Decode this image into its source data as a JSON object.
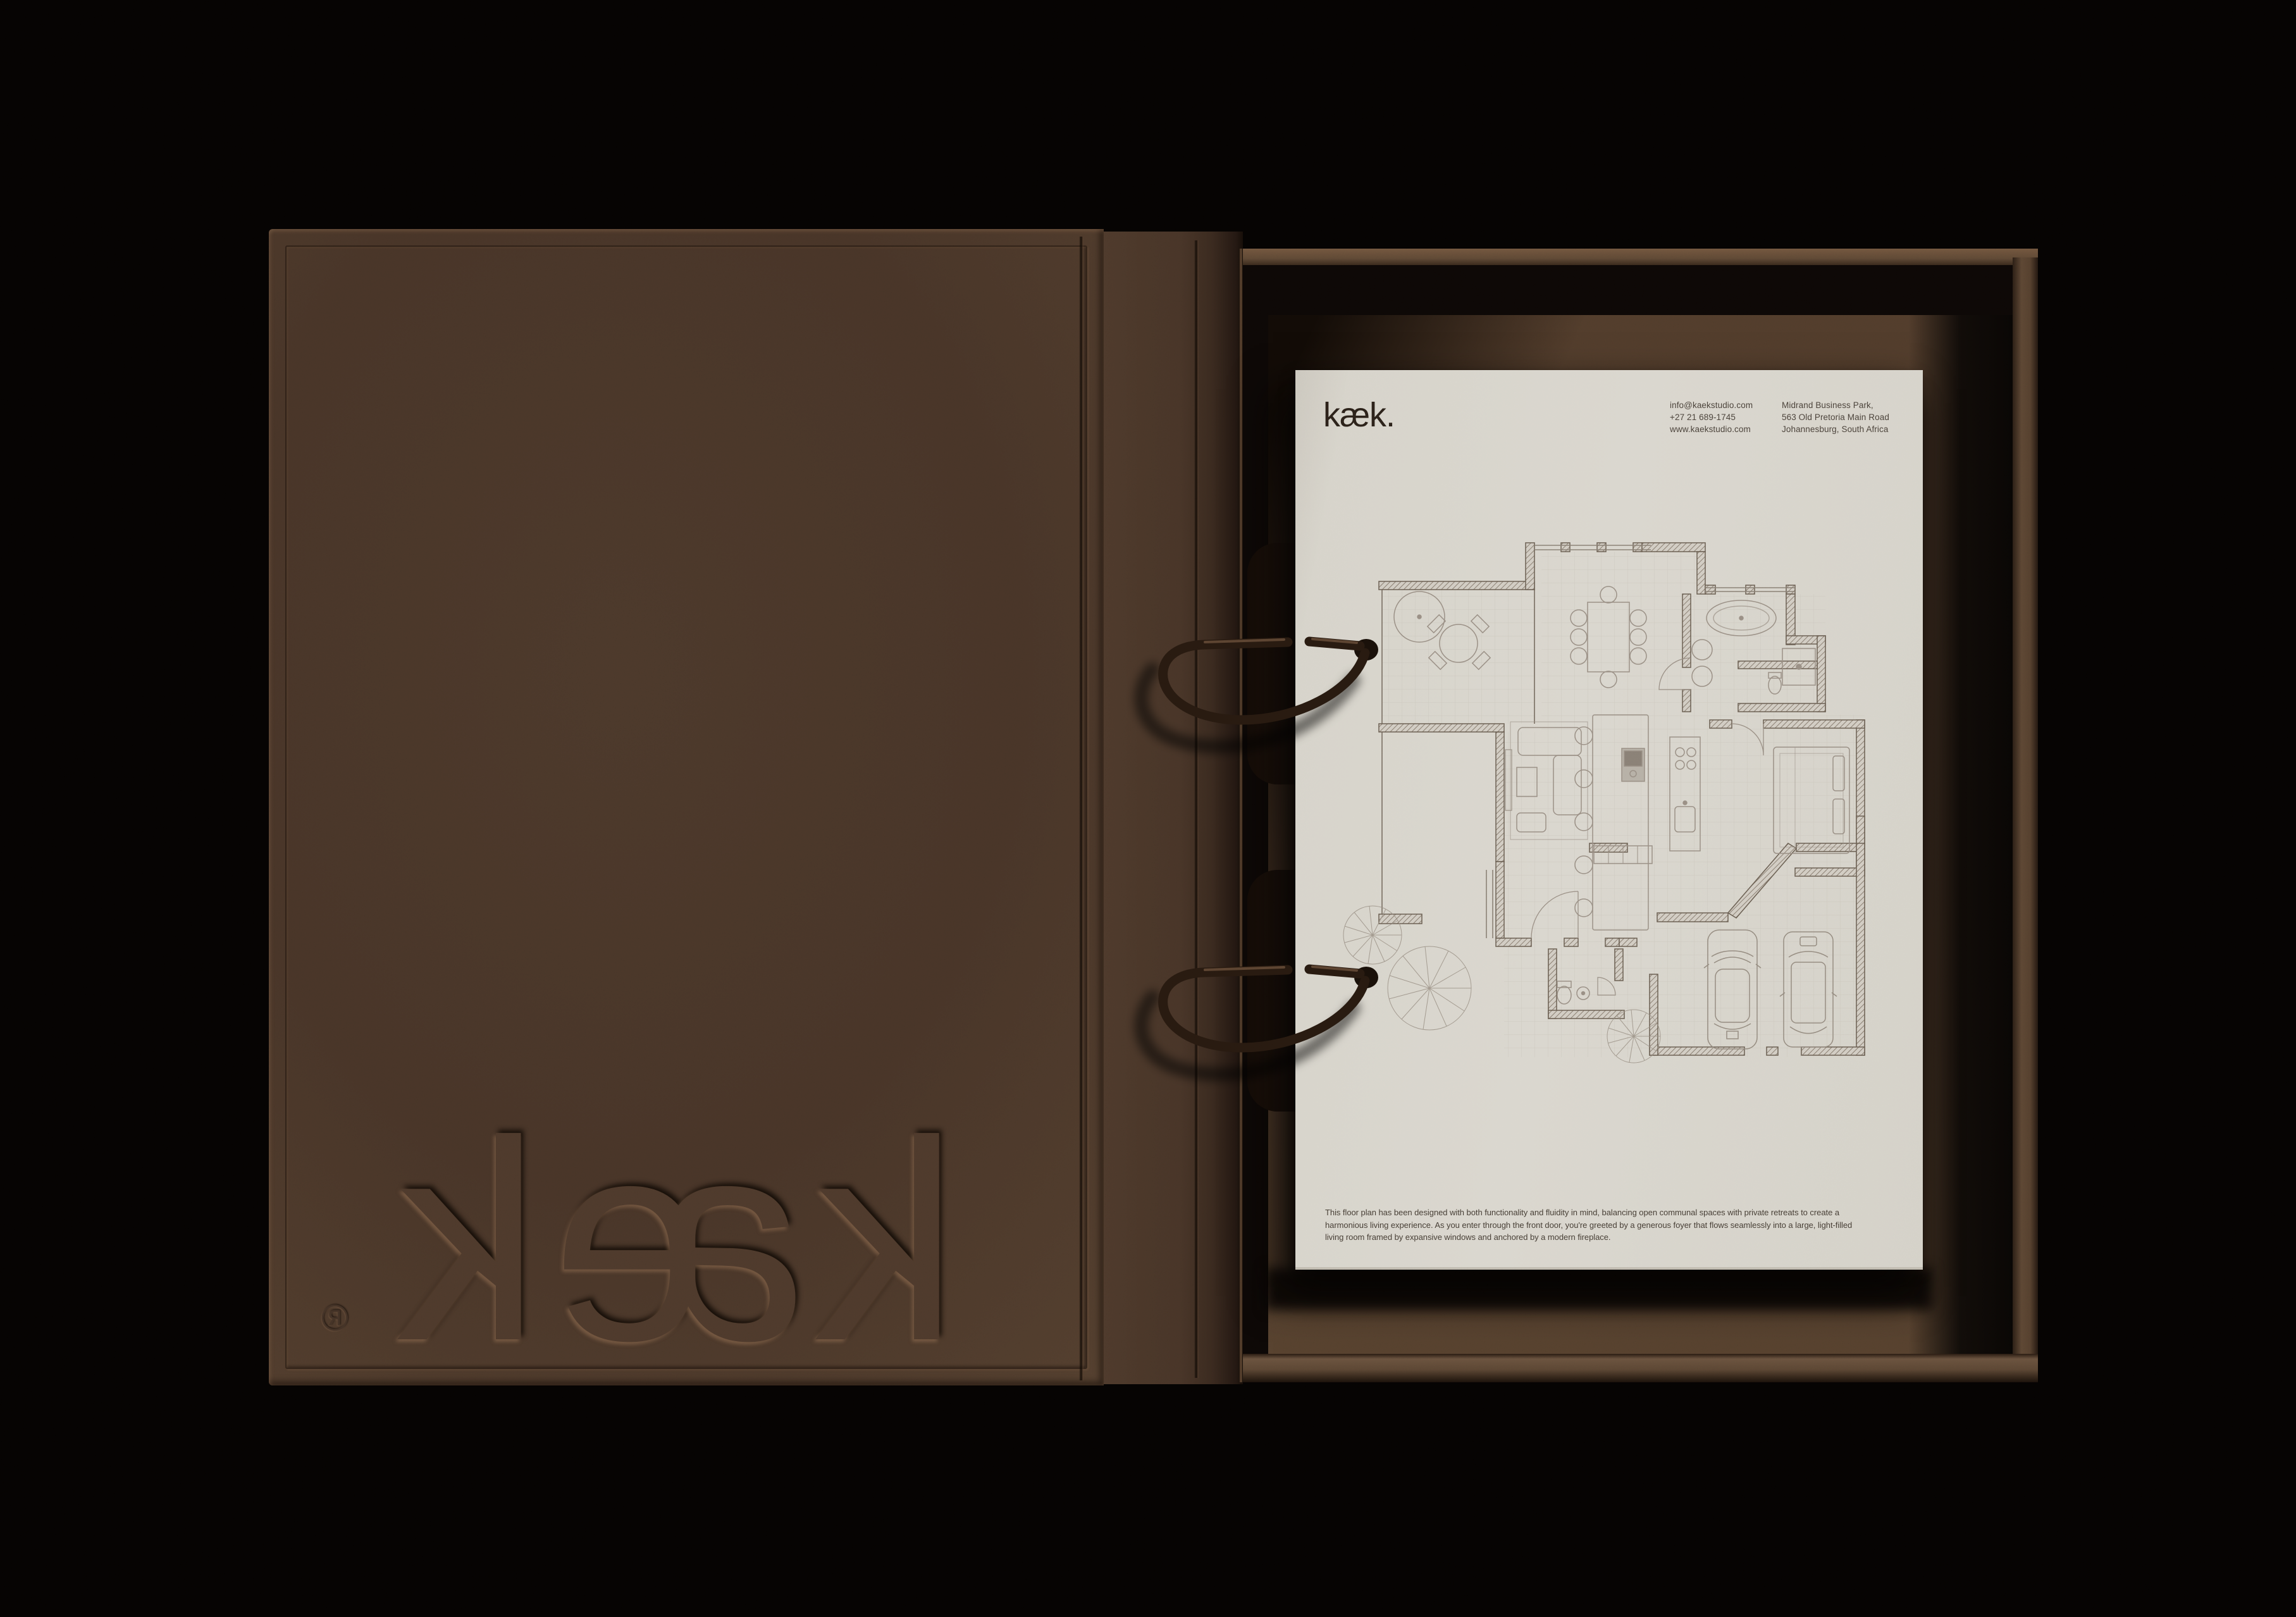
{
  "scene": {
    "background_color": "#050302",
    "cover_brown": "#4a3729",
    "paper_color": "#d8d5cc",
    "ring_color": "#281a10"
  },
  "cover": {
    "logo_text": "kæk",
    "registered_mark": "®"
  },
  "paper": {
    "logo": "kæk.",
    "contact": {
      "col1": [
        "info@kaekstudio.com",
        "+27 21 689-1745",
        "www.kaekstudio.com"
      ],
      "col2": [
        "Midrand Business Park,",
        "563 Old Pretoria Main Road",
        "Johannesburg, South Africa"
      ]
    },
    "description": "This floor plan has been designed with both functionality and fluidity in mind, balancing open communal spaces with private retreats to create a harmonious living experience. As you enter through the front door, you're greeted by a generous foyer that flows seamlessly into a large, light-filled living room framed by expansive windows and anchored by a modern fireplace."
  }
}
